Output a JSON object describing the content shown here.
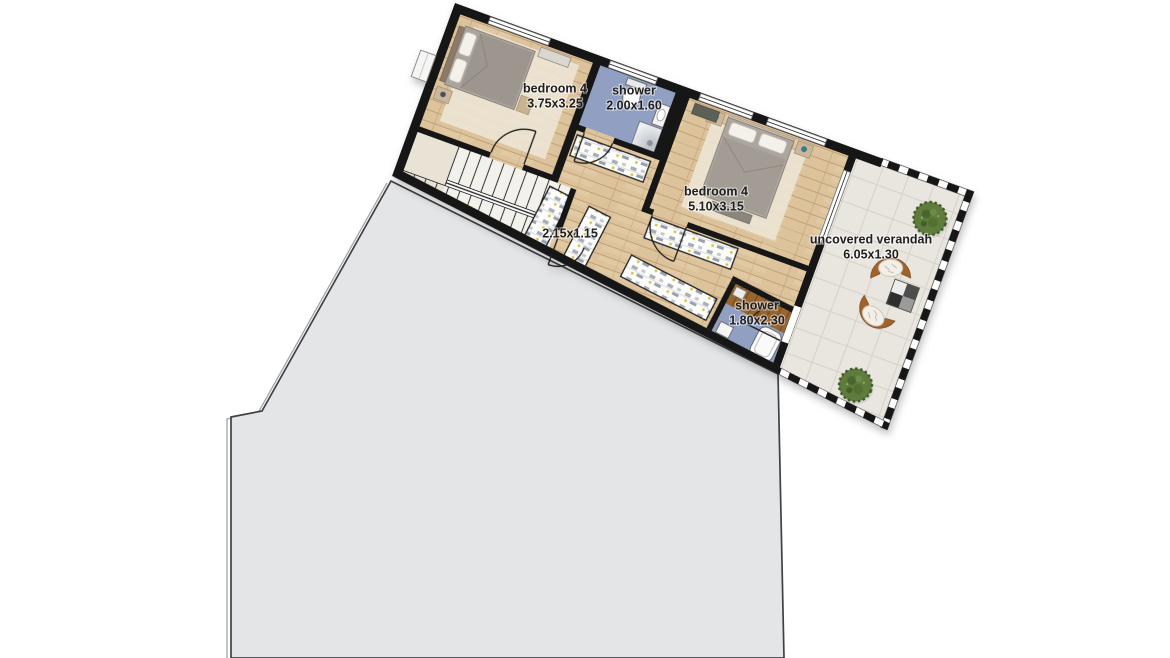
{
  "floor_plan": {
    "rooms": [
      {
        "name": "bedroom 4",
        "dims": "3.75x3.25"
      },
      {
        "name": "shower",
        "dims": "2.00x1.60"
      },
      {
        "name": "bedroom 4",
        "dims": "5.10x3.15"
      },
      {
        "name": "uncovered verandah",
        "dims": "6.05x1.30"
      },
      {
        "dims": "2.15x1.15"
      },
      {
        "name": "shower",
        "dims": "1.80x2.30"
      }
    ],
    "colors": {
      "wall": "#161616",
      "wood_floor": "#dcc39c",
      "bathroom_floor": "#91a0c2",
      "verandah_tile": "#e9e6df",
      "deck_wood": "#99652f",
      "stairs_floor": "#f2f1ec",
      "roof_outline_fill": "#e4e5e7",
      "plant_green": "#5e7c3d",
      "rattan_chair": "#a2622b"
    }
  }
}
